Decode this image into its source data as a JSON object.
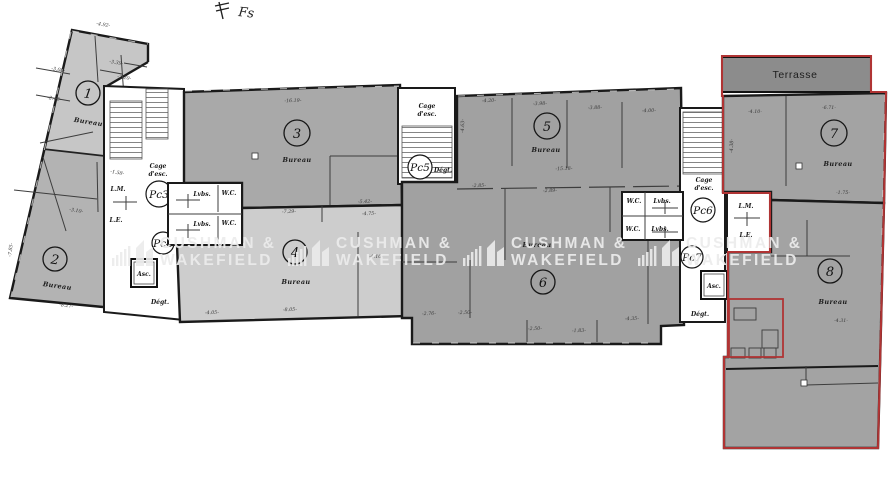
{
  "watermark": {
    "line1": "CUSHMAN &",
    "line2": "WAKEFIELD"
  },
  "handwritten_mark": "Fs",
  "terrasse": "Terrasse",
  "rooms": [
    {
      "number": "1",
      "label": "Bureau"
    },
    {
      "number": "2",
      "label": "Bureau"
    },
    {
      "number": "3",
      "label": "Bureau"
    },
    {
      "number": "4",
      "label": "Bureau"
    },
    {
      "number": "5",
      "label": "Bureau"
    },
    {
      "number": "6",
      "label": "Bureau"
    },
    {
      "number": "7",
      "label": "Bureau"
    },
    {
      "number": "8",
      "label": "Bureau"
    }
  ],
  "pc": {
    "pc3": "Pc3",
    "pc4": "Pc4",
    "pc5": "Pc5",
    "pc6": "Pc6",
    "pc7": "Pc7"
  },
  "labels": {
    "cage_line1": "Cage",
    "cage_line2": "d'esc.",
    "degt": "Dégt.",
    "asc": "Asc.",
    "lm": "L.M.",
    "le": "L.E.",
    "wc": "W.C.",
    "lvbs": "Lvbs."
  },
  "dimensions": [
    {
      "t": "-4.92-"
    },
    {
      "t": "-3.39-"
    },
    {
      "t": "-2.20-"
    },
    {
      "t": "-3.08-"
    },
    {
      "t": "-2.42-"
    },
    {
      "t": "-1.58-"
    },
    {
      "t": "-3.10-"
    },
    {
      "t": "-8.27-"
    },
    {
      "t": "-7.85-"
    },
    {
      "t": "-16.19-"
    },
    {
      "t": "-5.42-"
    },
    {
      "t": "-7.29-"
    },
    {
      "t": "-4.75-"
    },
    {
      "t": "-8.05-"
    },
    {
      "t": "-4.05-"
    },
    {
      "t": "-4.10-"
    },
    {
      "t": "-4.20-"
    },
    {
      "t": "-3.98-"
    },
    {
      "t": "-3.88-"
    },
    {
      "t": "-4.00-"
    },
    {
      "t": "-15.18-"
    },
    {
      "t": "-2.85-"
    },
    {
      "t": "-2.89-"
    },
    {
      "t": "-2.76-"
    },
    {
      "t": "-2.50-"
    },
    {
      "t": "-2.50-"
    },
    {
      "t": "-1.83-"
    },
    {
      "t": "-4.35-"
    },
    {
      "t": "-4.10-"
    },
    {
      "t": "-6.71-"
    },
    {
      "t": "-1.75-"
    },
    {
      "t": "-4.31-"
    },
    {
      "t": "-4.63-"
    },
    {
      "t": "-4.38-"
    }
  ]
}
